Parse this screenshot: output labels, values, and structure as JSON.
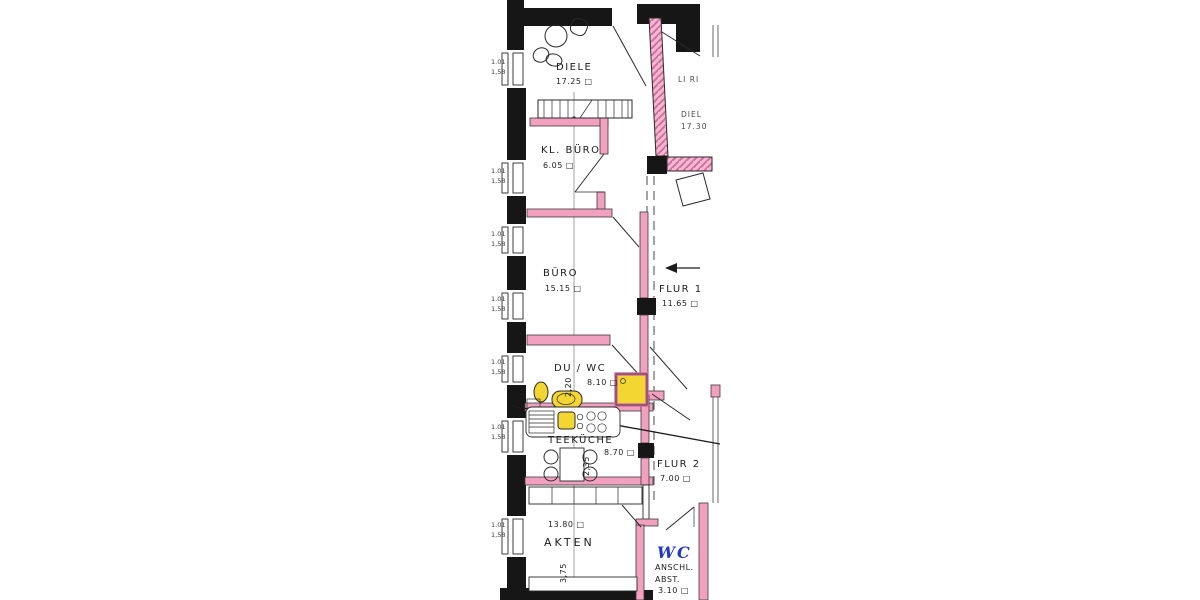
{
  "page": {
    "type": "scanned architectural floor plan",
    "language": "de",
    "background": "#ffffff"
  },
  "colors": {
    "outer_wall_black": "#161616",
    "partition_wall_pink": "#f2a0c0",
    "party_wall_hatch_pink": "#cf6f9f",
    "fixture_yellow": "#f3d631",
    "handwritten_blue": "#2438c8",
    "line_ink": "#2a2a2a"
  },
  "rooms": {
    "diele": {
      "name": "DIELE",
      "area": "17.25 □"
    },
    "kl_buero": {
      "name": "KL. BÜRO",
      "area": "6.05 □"
    },
    "buero": {
      "name": "BÜRO",
      "area": "15.15 □"
    },
    "flur1": {
      "name": "FLUR 1",
      "area": "11.65 □"
    },
    "du_wc": {
      "name": "DU / WC",
      "area": "8.10 □",
      "depth": "2,20"
    },
    "teekueche": {
      "name": "TEEKÜCHE",
      "area": "8.70 □",
      "depth": "2,35"
    },
    "flur2": {
      "name": "FLUR 2",
      "area": "7.00 □"
    },
    "akten": {
      "name": "AKTEN",
      "area": "13.80 □",
      "depth": "3,75"
    },
    "wc_anschluss": {
      "name": "WC",
      "line2": "ANSCHL.",
      "line3": "ABST.",
      "area": "3.10 □"
    },
    "neighbor": {
      "label": "LI RI",
      "name": "DIEL",
      "area": "17.30"
    }
  },
  "window_label": {
    "line1": "1.01",
    "line2": "1,58"
  }
}
